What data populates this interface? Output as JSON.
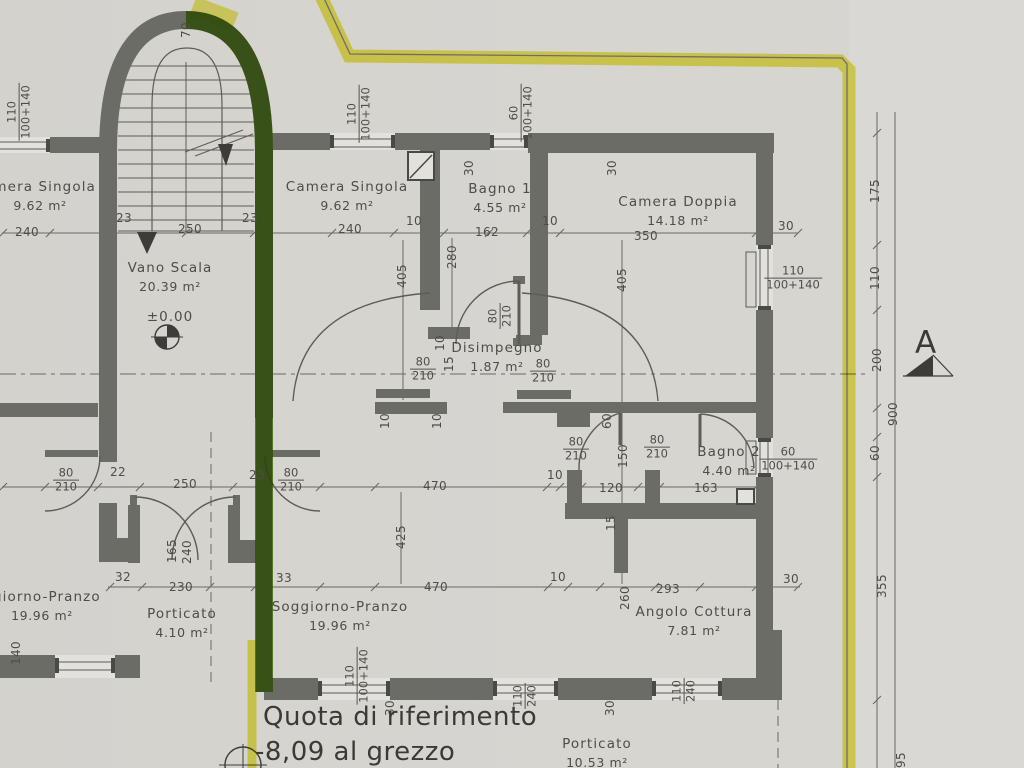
{
  "meta": {
    "drawing_type": "architectural floor plan (scanned)",
    "sheet_note_line1": "Quota di riferimento",
    "sheet_note_line2": "-8,09 al grezzo",
    "section_marker": "A",
    "level_mark": "±0.00"
  },
  "colors": {
    "paper": "#d6d4cf",
    "wall": "#6c6c66",
    "pencil_line": "#5f5d58",
    "text": "#4f4d48",
    "highlight_yellow": "#e8e334",
    "highlight_green": "#6fb31c"
  },
  "rooms": [
    {
      "name": "Camera Singola",
      "area": "9.62 m²",
      "x": 347,
      "y": 196
    },
    {
      "name": "Bagno 1",
      "area": "4.55 m²",
      "x": 500,
      "y": 198
    },
    {
      "name": "Camera Doppia",
      "area": "14.18 m²",
      "x": 678,
      "y": 211
    },
    {
      "name": "Vano Scala",
      "area": "20.39 m²",
      "x": 170,
      "y": 277
    },
    {
      "name": "Disimpegno",
      "area": "1.87 m²",
      "x": 497,
      "y": 357
    },
    {
      "name": "Bagno 2",
      "area": "4.40 m²",
      "x": 729,
      "y": 461
    },
    {
      "name": "Soggiorno-Pranzo",
      "area": "19.96 m²",
      "x": 340,
      "y": 616
    },
    {
      "name": "Porticato",
      "area": "4.10 m²",
      "x": 182,
      "y": 623
    },
    {
      "name": "Angolo Cottura",
      "area": "7.81 m²",
      "x": 694,
      "y": 621
    },
    {
      "name": "amera Singola",
      "area": "9.62 m²",
      "x": 40,
      "y": 196
    },
    {
      "name": "ggiorno-Pranzo",
      "area": "19.96 m²",
      "x": 42,
      "y": 606
    },
    {
      "name": "Porticato",
      "area": "10.53 m²",
      "x": 597,
      "y": 753
    }
  ],
  "dims": [
    {
      "t": "240",
      "x": 27,
      "y": 232,
      "r": 0
    },
    {
      "t": "23",
      "x": 124,
      "y": 218,
      "r": 0
    },
    {
      "t": "250",
      "x": 190,
      "y": 229,
      "r": 0
    },
    {
      "t": "23",
      "x": 250,
      "y": 218,
      "r": 0
    },
    {
      "t": "240",
      "x": 350,
      "y": 229,
      "r": 0
    },
    {
      "t": "10",
      "x": 414,
      "y": 221,
      "r": 0
    },
    {
      "t": "162",
      "x": 487,
      "y": 232,
      "r": 0
    },
    {
      "t": "10",
      "x": 550,
      "y": 221,
      "r": 0
    },
    {
      "t": "350",
      "x": 646,
      "y": 236,
      "r": 0
    },
    {
      "t": "30",
      "x": 786,
      "y": 226,
      "r": 0
    },
    {
      "t": "70",
      "x": 186,
      "y": 30,
      "r": -90
    },
    {
      "t": "30",
      "x": 469,
      "y": 168,
      "r": -90
    },
    {
      "t": "30",
      "x": 612,
      "y": 168,
      "r": -90
    },
    {
      "t": "405",
      "x": 402,
      "y": 276,
      "r": -90
    },
    {
      "t": "280",
      "x": 452,
      "y": 257,
      "r": -90
    },
    {
      "t": "405",
      "x": 622,
      "y": 280,
      "r": -90
    },
    {
      "t": "10",
      "x": 440,
      "y": 343,
      "r": -90
    },
    {
      "t": "15",
      "x": 449,
      "y": 364,
      "r": -90
    },
    {
      "t": "10",
      "x": 385,
      "y": 421,
      "r": -90
    },
    {
      "t": "10",
      "x": 437,
      "y": 421,
      "r": -90
    },
    {
      "t": "60",
      "x": 607,
      "y": 421,
      "r": -90
    },
    {
      "t": "150",
      "x": 623,
      "y": 456,
      "r": -90
    },
    {
      "t": "15",
      "x": 611,
      "y": 523,
      "r": -90
    },
    {
      "t": "260",
      "x": 625,
      "y": 598,
      "r": -90
    },
    {
      "t": "425",
      "x": 401,
      "y": 537,
      "r": -90
    },
    {
      "t": "165",
      "x": 172,
      "y": 551,
      "r": -90
    },
    {
      "t": "240",
      "x": 187,
      "y": 552,
      "r": -90
    },
    {
      "t": "140",
      "x": 16,
      "y": 653,
      "r": -90
    },
    {
      "t": "22",
      "x": 118,
      "y": 472,
      "r": 0
    },
    {
      "t": "250",
      "x": 185,
      "y": 484,
      "r": 0
    },
    {
      "t": "23",
      "x": 257,
      "y": 475,
      "r": 0
    },
    {
      "t": "470",
      "x": 435,
      "y": 486,
      "r": 0
    },
    {
      "t": "10",
      "x": 555,
      "y": 475,
      "r": 0
    },
    {
      "t": "120",
      "x": 611,
      "y": 488,
      "r": 0
    },
    {
      "t": "163",
      "x": 706,
      "y": 488,
      "r": 0
    },
    {
      "t": "32",
      "x": 123,
      "y": 577,
      "r": 0
    },
    {
      "t": "230",
      "x": 181,
      "y": 587,
      "r": 0
    },
    {
      "t": "33",
      "x": 284,
      "y": 578,
      "r": 0
    },
    {
      "t": "470",
      "x": 436,
      "y": 587,
      "r": 0
    },
    {
      "t": "10",
      "x": 558,
      "y": 577,
      "r": 0
    },
    {
      "t": "293",
      "x": 668,
      "y": 589,
      "r": 0
    },
    {
      "t": "30",
      "x": 791,
      "y": 579,
      "r": 0
    },
    {
      "t": "30",
      "x": 390,
      "y": 708,
      "r": -90
    },
    {
      "t": "30",
      "x": 610,
      "y": 708,
      "r": -90
    },
    {
      "t": "175",
      "x": 875,
      "y": 191,
      "r": -90
    },
    {
      "t": "110",
      "x": 875,
      "y": 278,
      "r": -90
    },
    {
      "t": "200",
      "x": 877,
      "y": 360,
      "r": -90
    },
    {
      "t": "60",
      "x": 875,
      "y": 453,
      "r": -90
    },
    {
      "t": "900",
      "x": 893,
      "y": 414,
      "r": -90
    },
    {
      "t": "355",
      "x": 882,
      "y": 586,
      "r": -90
    },
    {
      "t": "95",
      "x": 901,
      "y": 760,
      "r": -90
    }
  ],
  "fracs": [
    {
      "a": "80",
      "b": "210",
      "x": 66,
      "y": 480,
      "r": 0
    },
    {
      "a": "80",
      "b": "210",
      "x": 291,
      "y": 480,
      "r": 0
    },
    {
      "a": "80",
      "b": "210",
      "x": 423,
      "y": 369,
      "r": 0
    },
    {
      "a": "80",
      "b": "210",
      "x": 543,
      "y": 371,
      "r": 0
    },
    {
      "a": "80",
      "b": "210",
      "x": 576,
      "y": 449,
      "r": 0
    },
    {
      "a": "80",
      "b": "210",
      "x": 657,
      "y": 447,
      "r": 0
    },
    {
      "a": "80",
      "b": "210",
      "x": 500,
      "y": 316,
      "r": -90
    },
    {
      "a": "110",
      "b": "100+140",
      "x": 359,
      "y": 114,
      "r": -90
    },
    {
      "a": "60",
      "b": "100+140",
      "x": 521,
      "y": 113,
      "r": -90
    },
    {
      "a": "110",
      "b": "100+140",
      "x": 19,
      "y": 112,
      "r": -90
    },
    {
      "a": "110",
      "b": "100+140",
      "x": 793,
      "y": 278,
      "r": 0
    },
    {
      "a": "60",
      "b": "100+140",
      "x": 788,
      "y": 459,
      "r": 0
    },
    {
      "a": "110",
      "b": "100+140",
      "x": 357,
      "y": 676,
      "r": -90
    },
    {
      "a": "110",
      "b": "240",
      "x": 525,
      "y": 696,
      "r": -90
    },
    {
      "a": "110",
      "b": "240",
      "x": 684,
      "y": 691,
      "r": -90
    }
  ]
}
